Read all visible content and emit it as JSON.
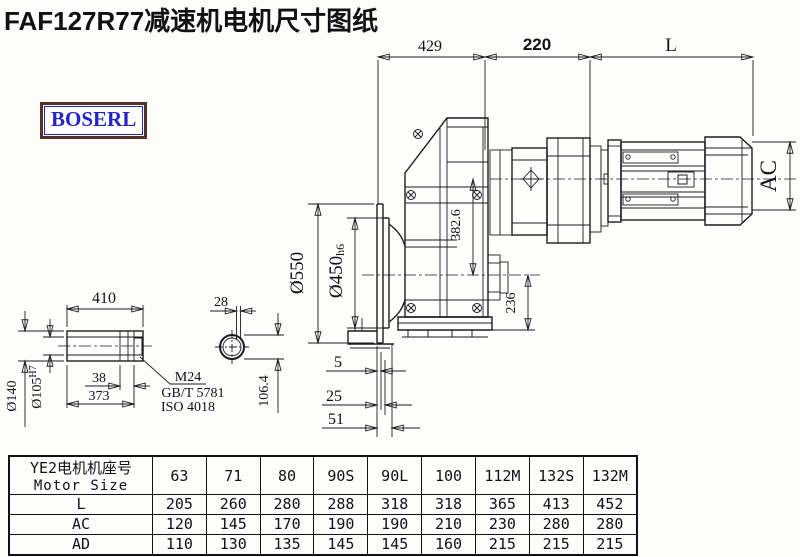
{
  "title": "FAF127R77减速机电机尺寸图纸",
  "logo": "BOSERL",
  "drawing": {
    "dims": {
      "top_429": "429",
      "top_220": "220",
      "top_L": "L",
      "ac": "AC",
      "d550": "Ø550",
      "d450": "Ø450",
      "d450_tol": "h6",
      "v382": "382.6",
      "v236": "236",
      "off5": "5",
      "off25": "25",
      "off51": "51",
      "shaft_410": "410",
      "key_28": "28",
      "shaft_38": "38",
      "shaft_373": "373",
      "d140": "Ø140",
      "d105": "Ø105",
      "d105_tol": "H7",
      "key_106": "106.4",
      "bolt_m24": "M24",
      "bolt_gb": "GB/T 5781",
      "bolt_iso": "ISO 4018"
    }
  },
  "table": {
    "header_cn": "YE2电机机座号",
    "header_en": "Motor Size",
    "sizes": [
      "63",
      "71",
      "80",
      "90S",
      "90L",
      "100",
      "112M",
      "132S",
      "132M"
    ],
    "rows": [
      {
        "label": "L",
        "values": [
          "205",
          "260",
          "280",
          "288",
          "318",
          "318",
          "365",
          "413",
          "452"
        ]
      },
      {
        "label": "AC",
        "values": [
          "120",
          "145",
          "170",
          "190",
          "190",
          "210",
          "230",
          "280",
          "280"
        ]
      },
      {
        "label": "AD",
        "values": [
          "110",
          "130",
          "135",
          "145",
          "145",
          "160",
          "215",
          "215",
          "215"
        ]
      }
    ]
  }
}
